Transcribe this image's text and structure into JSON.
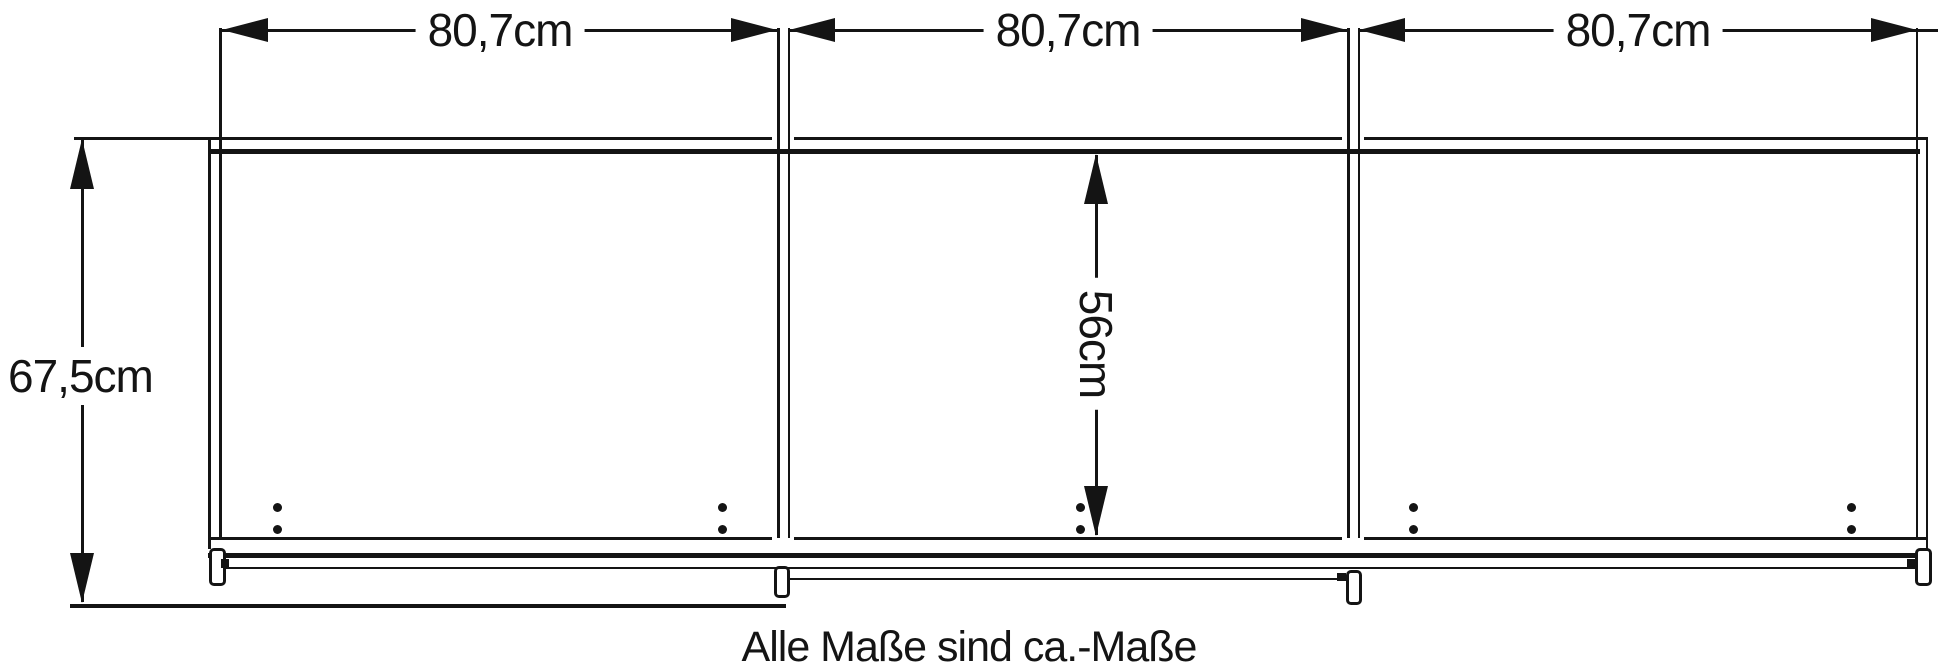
{
  "diagram": {
    "type": "furniture-dimension-drawing",
    "subject": "sliding-door cabinet front view, 3 door sections",
    "caption": "Alle Maße sind ca.-Maße",
    "unit": "cm",
    "dimensions": {
      "top_widths": [
        {
          "label": "80,7cm",
          "value_cm": 80.7
        },
        {
          "label": "80,7cm",
          "value_cm": 80.7
        },
        {
          "label": "80,7cm",
          "value_cm": 80.7
        }
      ],
      "left_height": {
        "label": "67,5cm",
        "value_cm": 67.5
      },
      "inner_height": {
        "label": "56cm",
        "value_cm": 56
      }
    },
    "colors": {
      "line": "#141414",
      "background": "#ffffff"
    }
  }
}
